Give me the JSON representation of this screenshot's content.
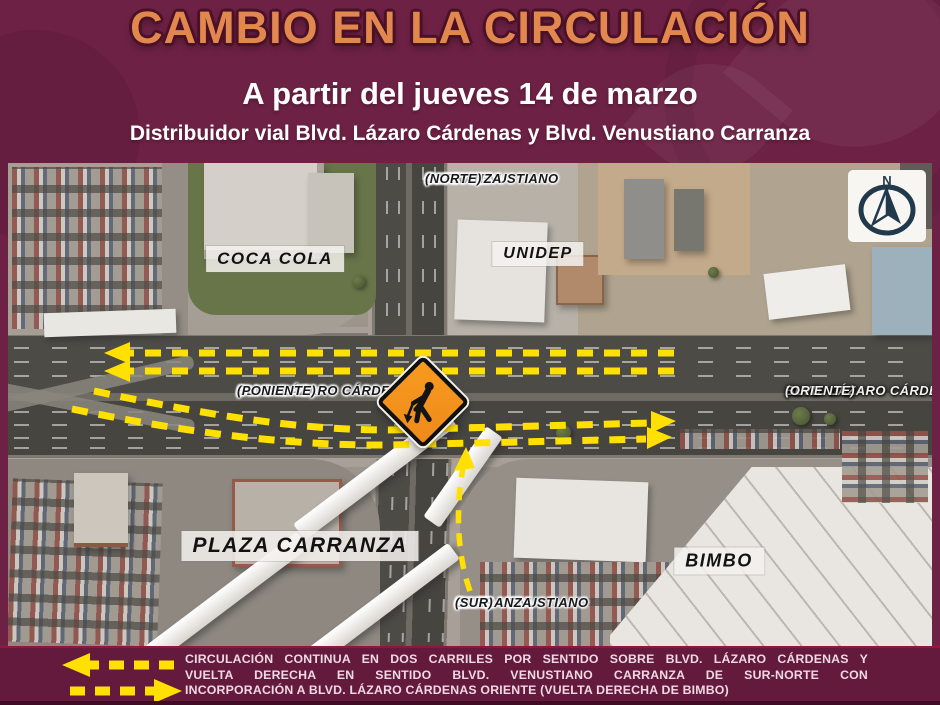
{
  "header": {
    "title": "CAMBIO EN LA CIRCULACIÓN",
    "date_line": "A partir del jueves 14 de marzo",
    "location_line": "Distribuidor vial Blvd. Lázaro Cárdenas y Blvd. Venustiano Carranza"
  },
  "map": {
    "road_labels": {
      "north": [
        "BLVD. VENUSTIANO",
        "CARRANZA",
        "(NORTE)"
      ],
      "south": [
        "BLVD. VENUSTIANO",
        "CARRANZA",
        "(SUR)"
      ],
      "west": [
        "BLVD. LÁZARO CÁRDENAS",
        "(PONIENTE)"
      ],
      "east": [
        "BLVD. LÁZARO CÁRDENAS",
        "(ORIENTE)"
      ]
    },
    "place_labels": {
      "coca_cola": "COCA COLA",
      "unidep": "UNIDEP",
      "plaza_carranza": "PLAZA CARRANZA",
      "bimbo": "BIMBO"
    },
    "compass_letter": "N"
  },
  "footer": {
    "line1": "CIRCULACIÓN CONTINUA EN DOS CARRILES POR SENTIDO SOBRE BLVD. LÁZARO CÁRDENAS Y",
    "line2": "VUELTA DERECHA EN SENTIDO BLVD. VENUSTIANO CARRANZA DE SUR-NORTE CON",
    "line3": "INCORPORACIÓN A BLVD. LÁZARO CÁRDENAS ORIENTE (VUELTA DERECHA DE BIMBO)"
  },
  "colors": {
    "background": "#6d2145",
    "title_orange": "#e2874e",
    "title_outline": "#4b1127",
    "arrow_yellow": "#ffe000",
    "sign_orange": "#ef8a1a",
    "footer_text": "#efd9e3",
    "footer_rule": "#97133b"
  }
}
